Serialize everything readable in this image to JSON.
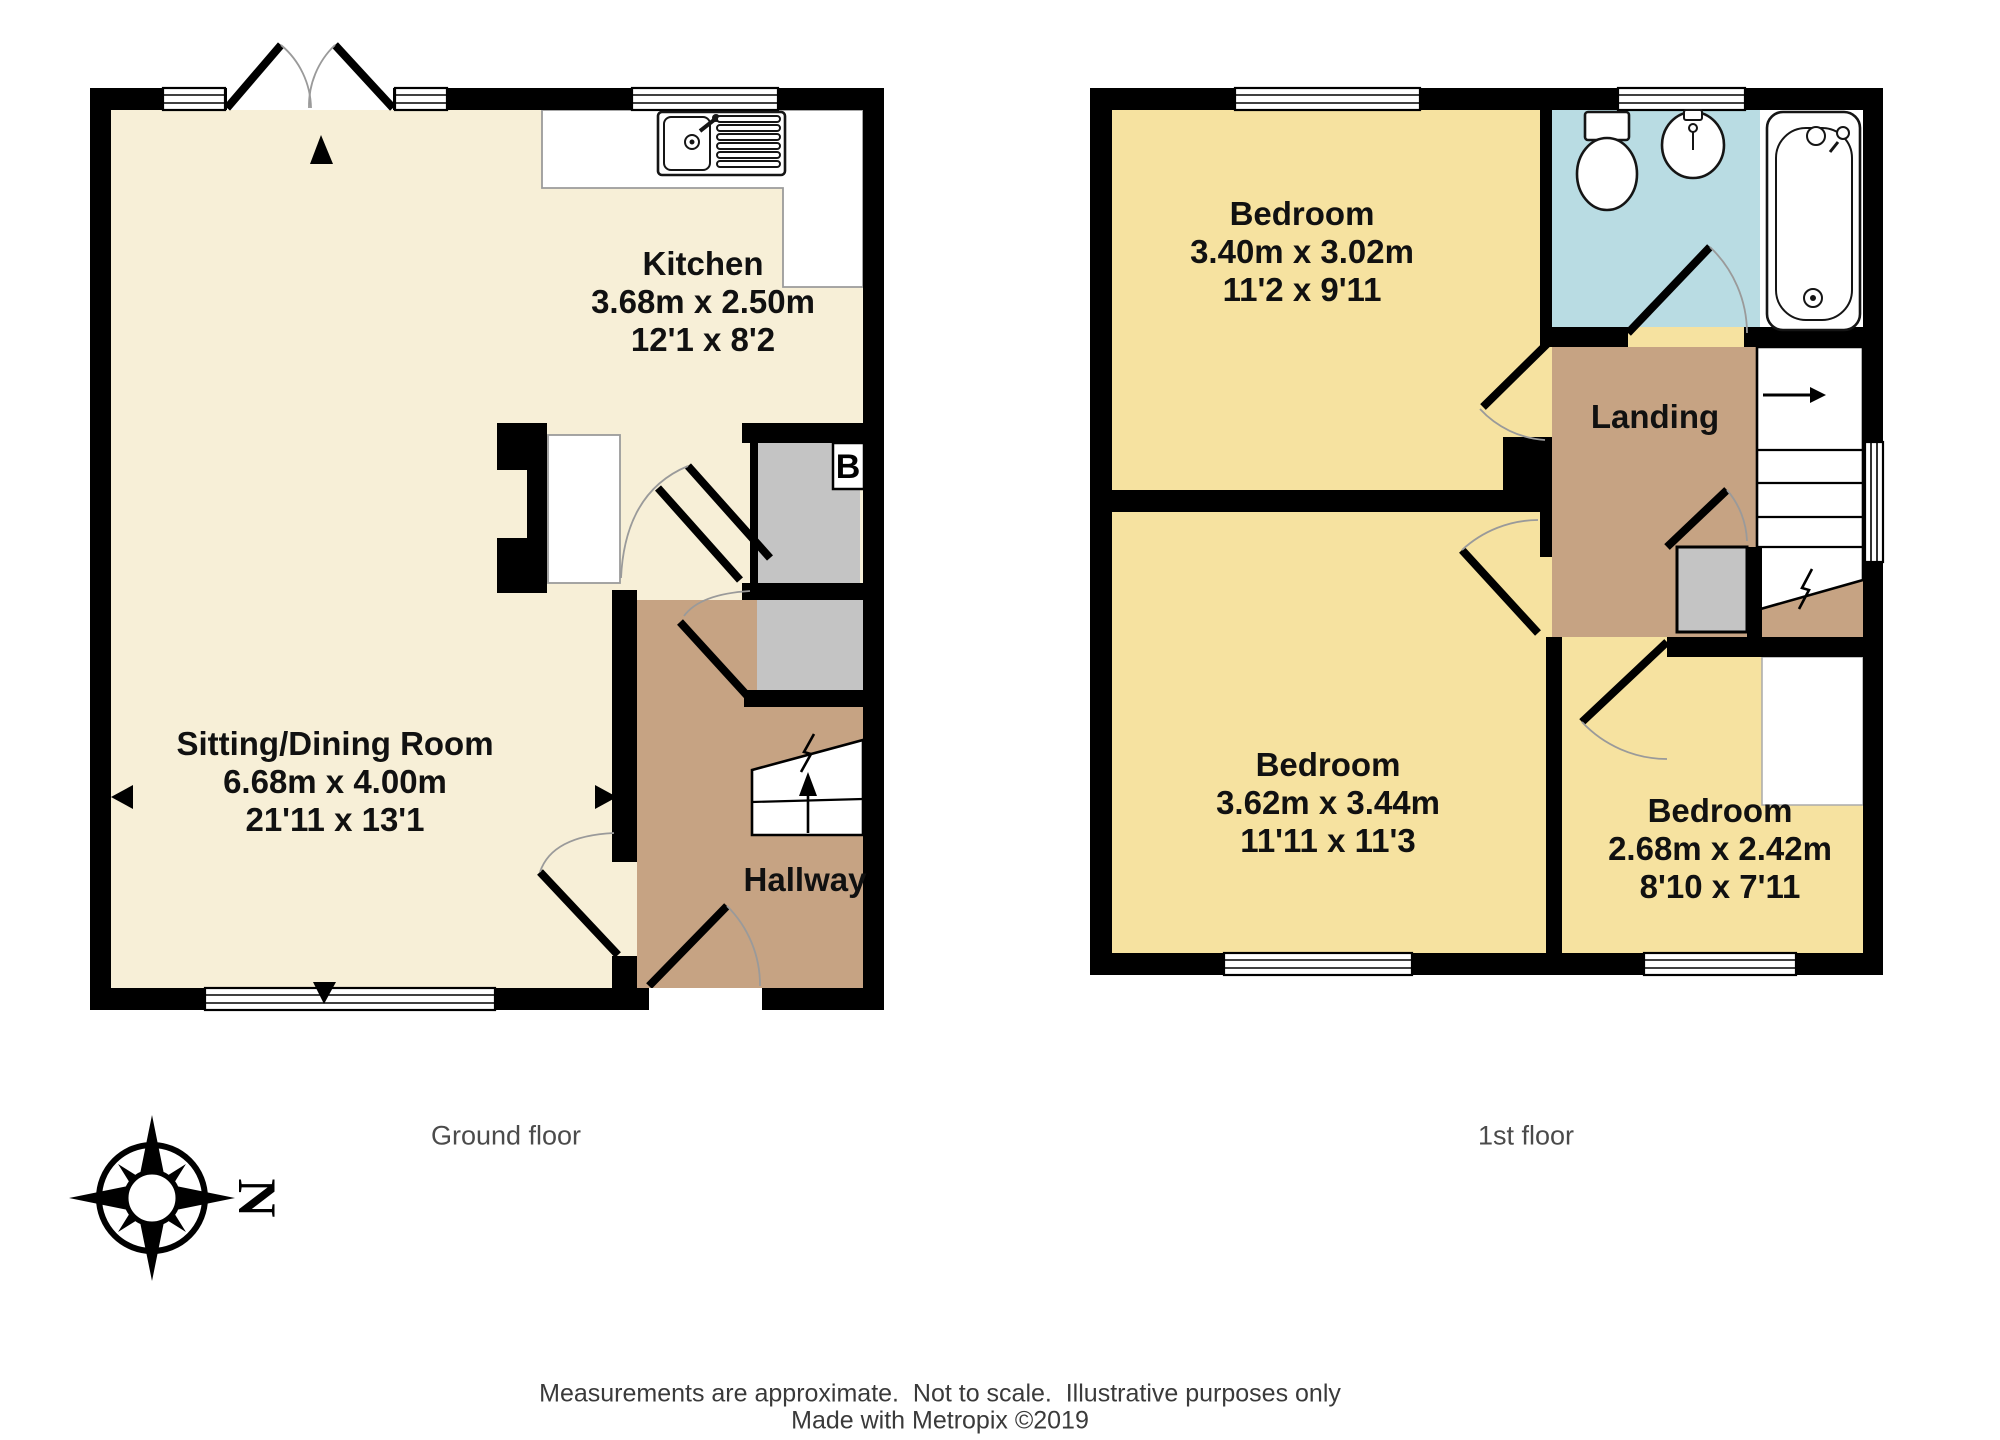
{
  "colors": {
    "cream": "#F7EFD7",
    "bedroom": "#F6E2A0",
    "hall": "#C6A383",
    "bath": "#B9DCE3",
    "closet": "#C4C4C4",
    "wall": "#000000"
  },
  "ground_floor": {
    "caption": "Ground floor",
    "rooms": {
      "sitting_dining": {
        "name": "Sitting/Dining Room",
        "metric": "6.68m x 4.00m",
        "imperial": "21'11 x 13'1"
      },
      "kitchen": {
        "name": "Kitchen",
        "metric": "3.68m x 2.50m",
        "imperial": "12'1 x 8'2"
      },
      "hallway": {
        "name": "Hallway"
      }
    },
    "boiler_label": "B"
  },
  "first_floor": {
    "caption": "1st floor",
    "rooms": {
      "bedroom1": {
        "name": "Bedroom",
        "metric": "3.40m x 3.02m",
        "imperial": "11'2 x 9'11"
      },
      "bedroom2": {
        "name": "Bedroom",
        "metric": "3.62m x 3.44m",
        "imperial": "11'11 x 11'3"
      },
      "bedroom3": {
        "name": "Bedroom",
        "metric": "2.68m x 2.42m",
        "imperial": "8'10 x 7'11"
      },
      "landing": {
        "name": "Landing"
      }
    }
  },
  "compass": {
    "north_label": "N"
  },
  "footer": {
    "line1": "Measurements are approximate.  Not to scale.  Illustrative purposes only",
    "line2": "Made with Metropix ©2019"
  },
  "icons": {
    "compass-rose-icon": "8-point star with ring",
    "sink-icon": "double bowl sink with drainer",
    "toilet-icon": "cistern + oval pan",
    "basin-icon": "oval basin with tap",
    "bathtub-icon": "rounded bath with taps",
    "stairs-up-arrow": "▲",
    "stairs-right-arrow": "→"
  }
}
